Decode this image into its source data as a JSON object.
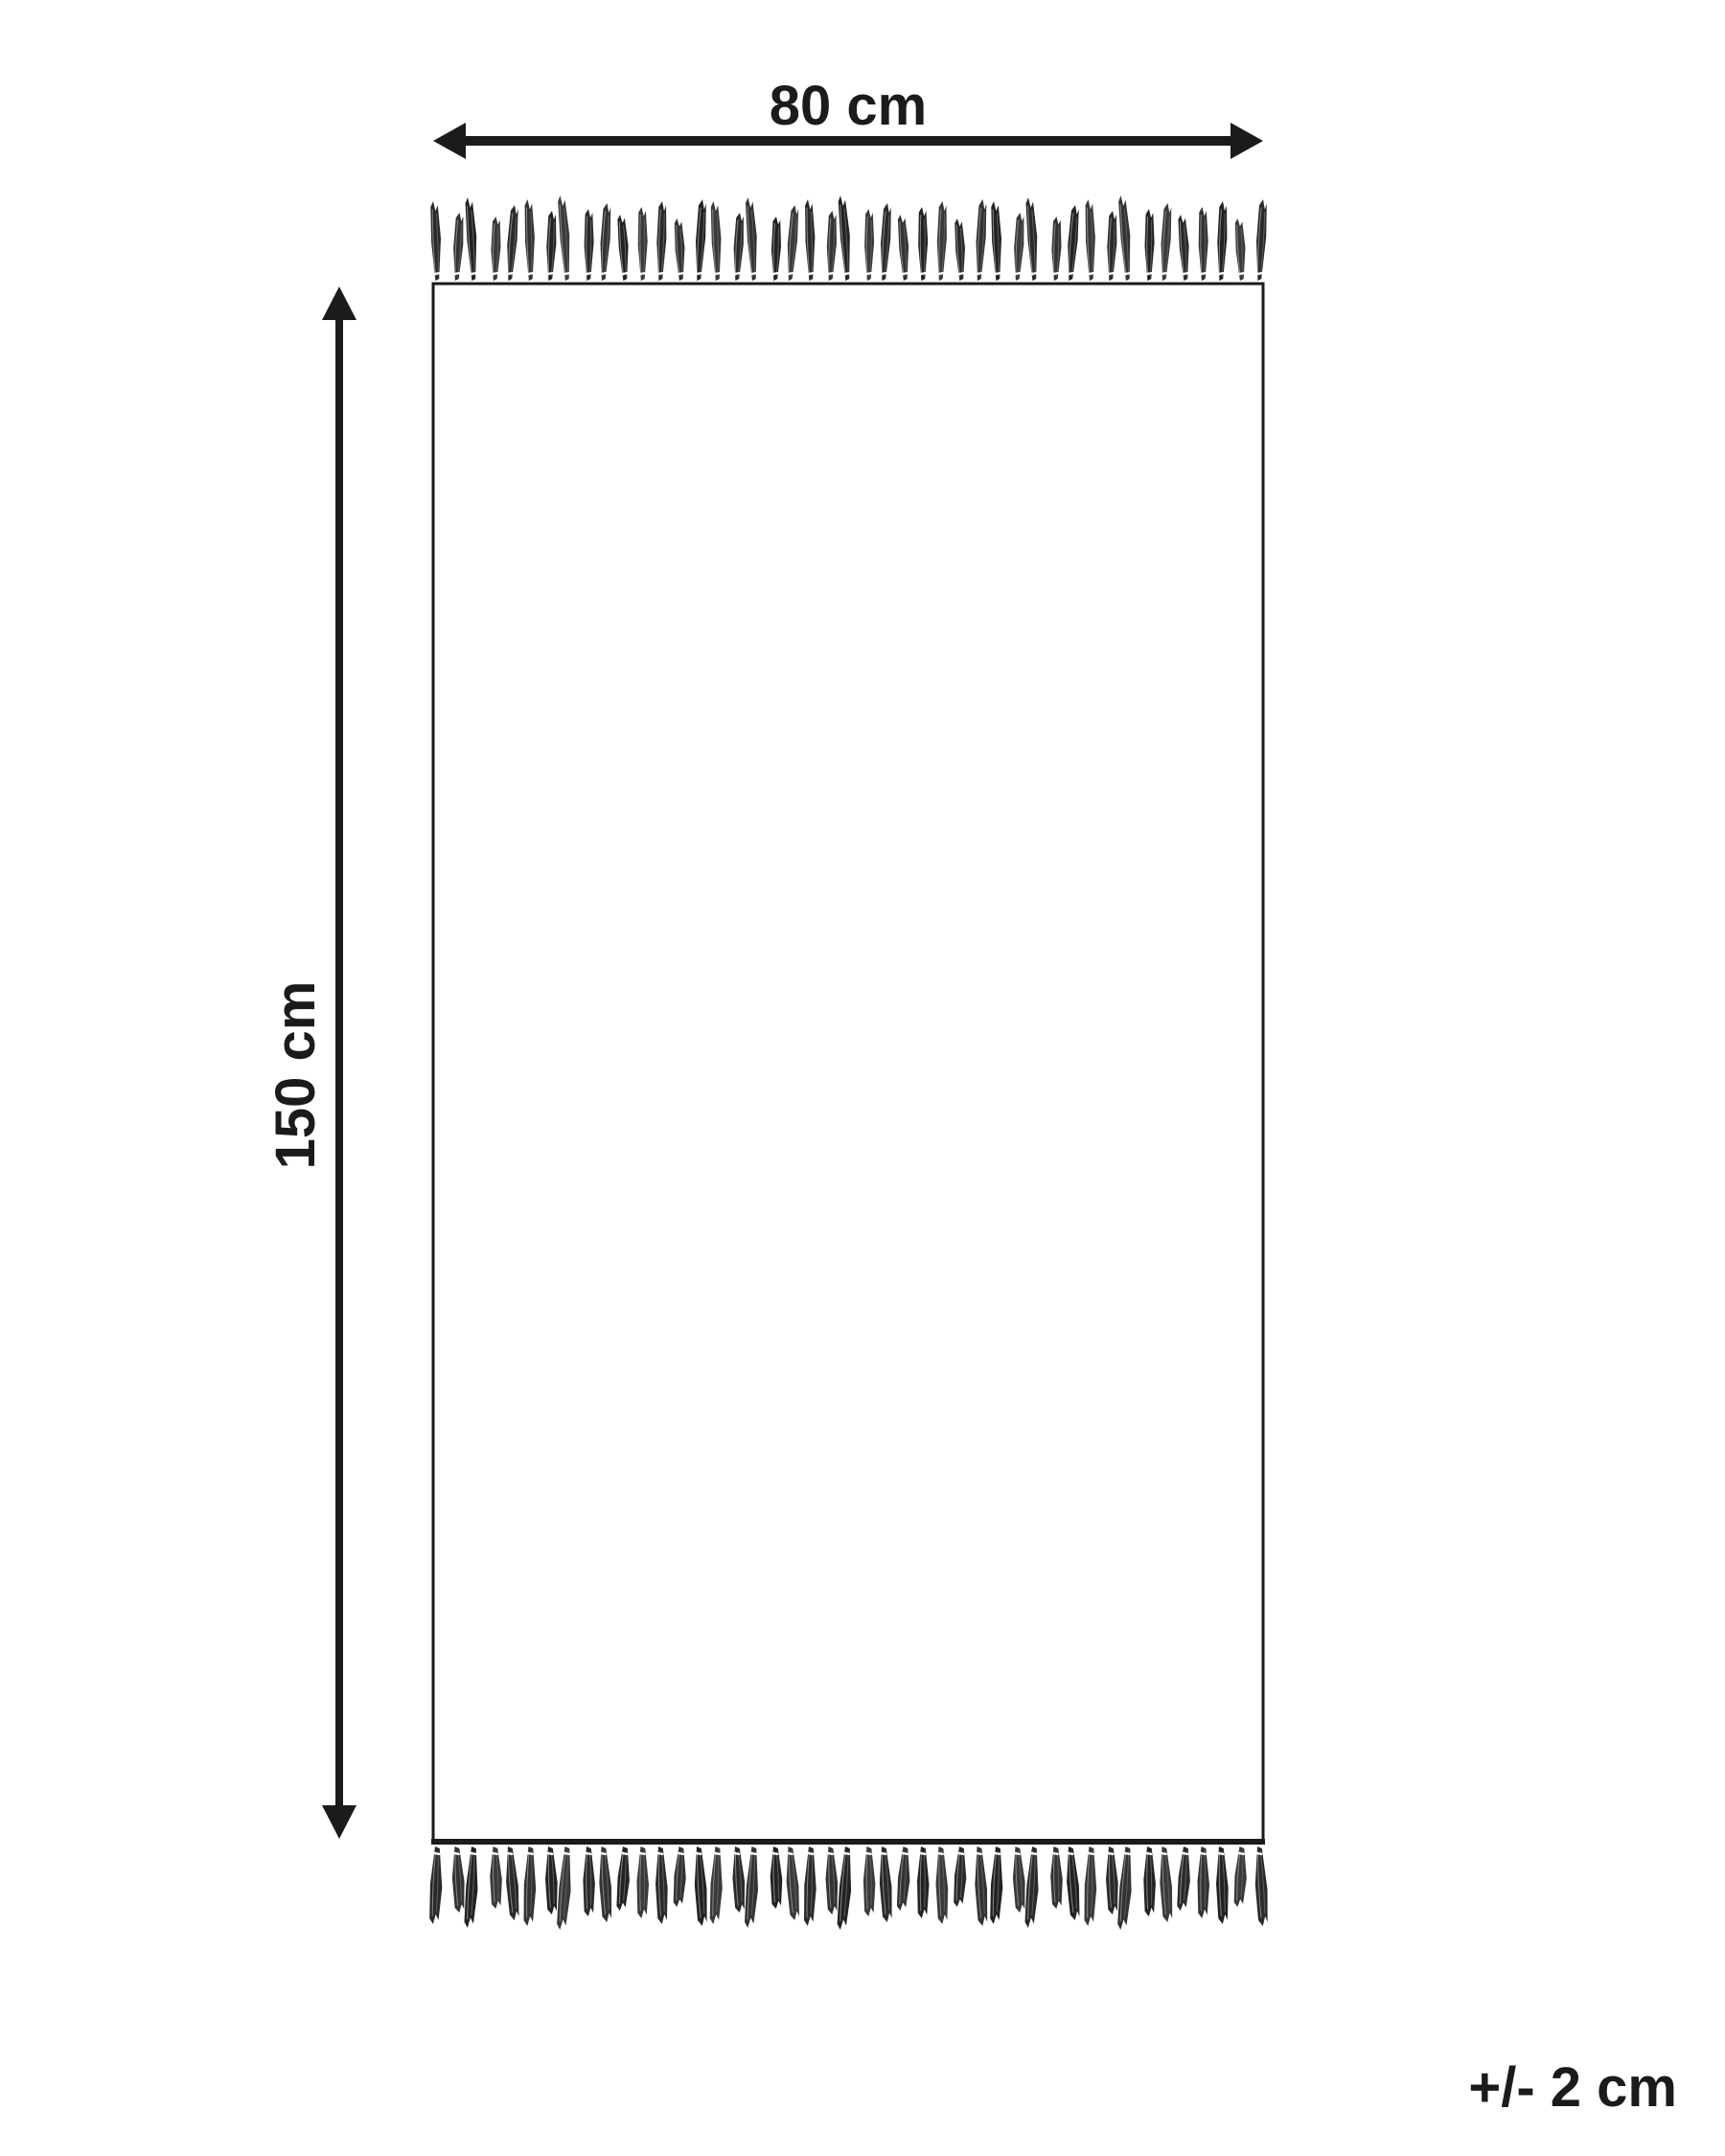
{
  "diagram": {
    "type": "product-dimension-diagram",
    "subject": "rug-with-fringe",
    "background_color": "#ffffff",
    "line_color": "#1d1a1b",
    "labels": {
      "width": "80 cm",
      "height": "150 cm",
      "tolerance": "+/- 2 cm"
    },
    "dimensions": {
      "width_cm": 80,
      "height_cm": 150,
      "tolerance_cm": 2
    },
    "fringe": {
      "top_count": 45,
      "bottom_count": 45,
      "shades": [
        "#2a2a2a",
        "#333333",
        "#222222",
        "#3a3a3a"
      ],
      "streak_light": "#8f8f8f",
      "streak_mid": "#5e5e5e",
      "tie_color": "#ffffff"
    }
  }
}
